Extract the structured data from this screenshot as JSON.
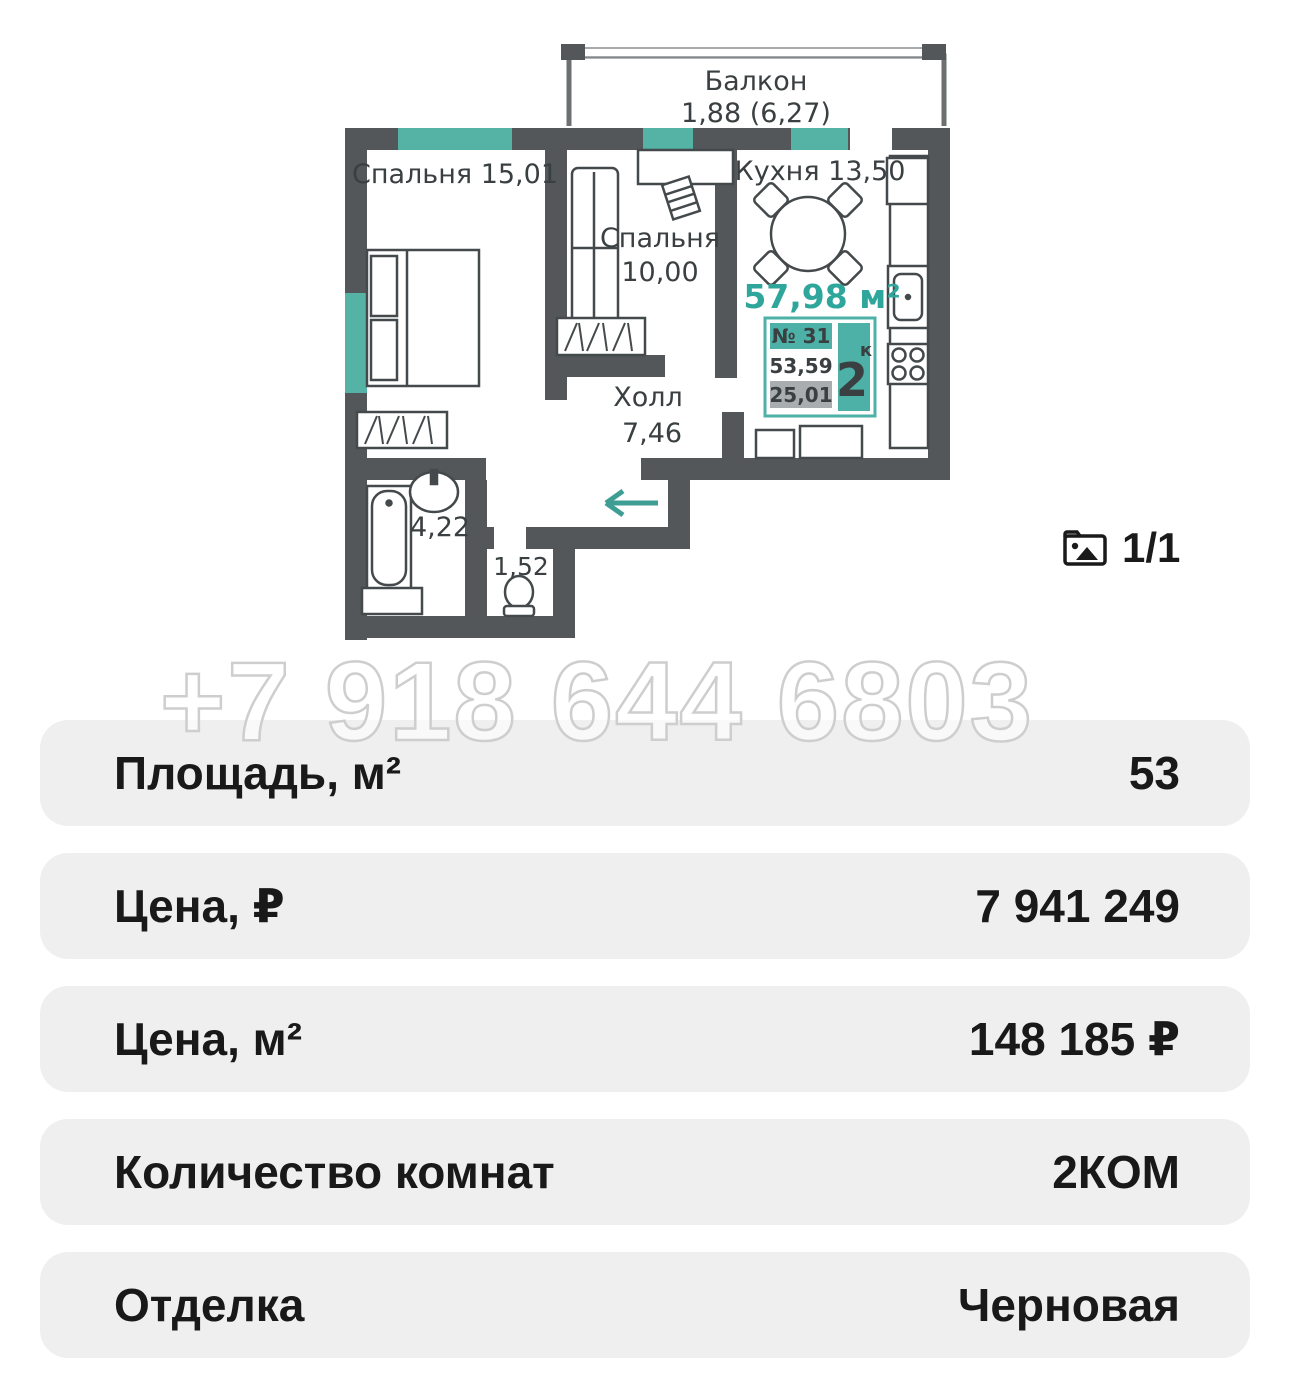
{
  "colors": {
    "wall": "#53575a",
    "window_teal": "#55b3a6",
    "accent_teal": "#2fa69b",
    "arrow_teal": "#3f9e94",
    "badge_teal": "#4db1a7",
    "badge_gray": "#a9adaf",
    "row_bg": "#efefef",
    "text_dark": "#191919"
  },
  "floorplan": {
    "balcony": {
      "name": "Балкон",
      "area": "1,88 (6,27)"
    },
    "bedroom1": {
      "label": "Спальня 15,01"
    },
    "bedroom2": {
      "name": "Спальня",
      "area": "10,00"
    },
    "kitchen": {
      "label": "Кухня  13,50"
    },
    "hall": {
      "name": "Холл",
      "area": "7,46"
    },
    "bathroom": {
      "area": "4,22"
    },
    "wc": {
      "area": "1,52"
    },
    "total_area": "57,98 м²",
    "badge": {
      "unit": "№ 31",
      "upper": "53,59",
      "lower": "25,01",
      "rooms": "2",
      "rooms_sup": "к"
    }
  },
  "photo_counter": {
    "label": "1/1"
  },
  "watermark": "+7 918 644 6803",
  "table": {
    "rows": [
      {
        "label": "Площадь, м²",
        "value": "53"
      },
      {
        "label": "Цена, ₽",
        "value": "7 941 249"
      },
      {
        "label": "Цена, м²",
        "value": "148 185 ₽"
      },
      {
        "label": "Количество комнат",
        "value": "2КОМ"
      },
      {
        "label": "Отделка",
        "value": "Черновая"
      }
    ]
  }
}
